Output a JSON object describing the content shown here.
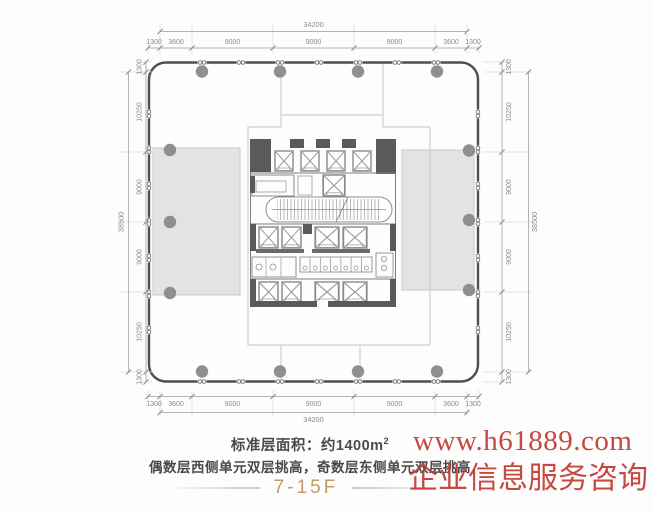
{
  "plan": {
    "dims": {
      "top": {
        "total": "34200",
        "segments": [
          "1300",
          "3600",
          "9000",
          "9000",
          "9000",
          "3600",
          "1300"
        ]
      },
      "bottom": {
        "total": "34200",
        "segments": [
          "1300",
          "3600",
          "9000",
          "9000",
          "9000",
          "3600",
          "1300"
        ]
      },
      "left": {
        "total": "38500",
        "segments": [
          "1300",
          "10250",
          "9000",
          "9000",
          "10250",
          "1300"
        ]
      },
      "right": {
        "total": "38500",
        "segments": [
          "1300",
          "10250",
          "9000",
          "9000",
          "10250",
          "1300"
        ]
      }
    },
    "colors": {
      "wall": "#4f4f4f",
      "column": "#8f8f8f",
      "shaded_zone": "#e3e3e3",
      "dim_line": "#b3b3b3",
      "dim_text": "#8a8a8a",
      "core_dark": "#5a5a5a",
      "setback_line": "#cfcfcf"
    }
  },
  "footer": {
    "area_label": "标准层面积：约1400m",
    "area_sup": "2",
    "note": "偶数层西侧单元双层挑高，奇数层东侧单元双层挑高",
    "floors": "7-15F",
    "floors_color": "#c49a63",
    "text_color": "#4a4a4a"
  },
  "watermark": {
    "url": "www.h61889.com",
    "caption": "企业信息服务咨询",
    "color": "#c23a30"
  }
}
